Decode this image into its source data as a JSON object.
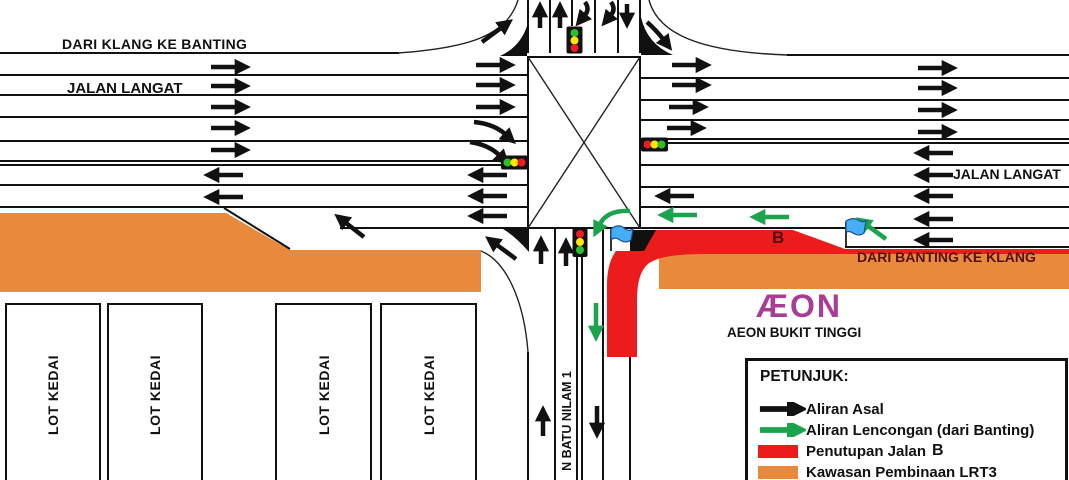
{
  "labels": {
    "top_road_direction": "DARI KLANG KE BANTING",
    "road_name_left": "JALAN LANGAT",
    "road_name_right": "JALAN LANGAT",
    "bottom_road_direction": "DARI BANTING KE KLANG",
    "closure_point": "B",
    "aeon_logo": "ÆON",
    "aeon_name": "AEON BUKIT TINGGI",
    "street_vertical": "N BATU NILAM 1",
    "shop_lot": "LOT KEDAI"
  },
  "legend": {
    "title": "PETUNJUK:",
    "items": [
      {
        "symbol": "black-arrow",
        "label": "Aliran Asal"
      },
      {
        "symbol": "green-arrow",
        "label": "Aliran Lencongan (dari Banting)"
      },
      {
        "symbol": "red-swatch",
        "label": "Penutupan Jalan",
        "suffix": "B"
      },
      {
        "symbol": "orange-swatch",
        "label": "Kawasan Pembinaan LRT3"
      }
    ]
  },
  "colors": {
    "ink": "#111111",
    "orange": "#E9893B",
    "red": "#ED1C1C",
    "green": "#1CA44D",
    "signal_red": "#ED1C24",
    "signal_yellow": "#FFE800",
    "signal_green": "#2DBE2D",
    "flag_blue": "#45AEF5",
    "flag_border": "#1D4F93",
    "maroon": "#541011",
    "aeon_magenta": "#A83C96"
  }
}
